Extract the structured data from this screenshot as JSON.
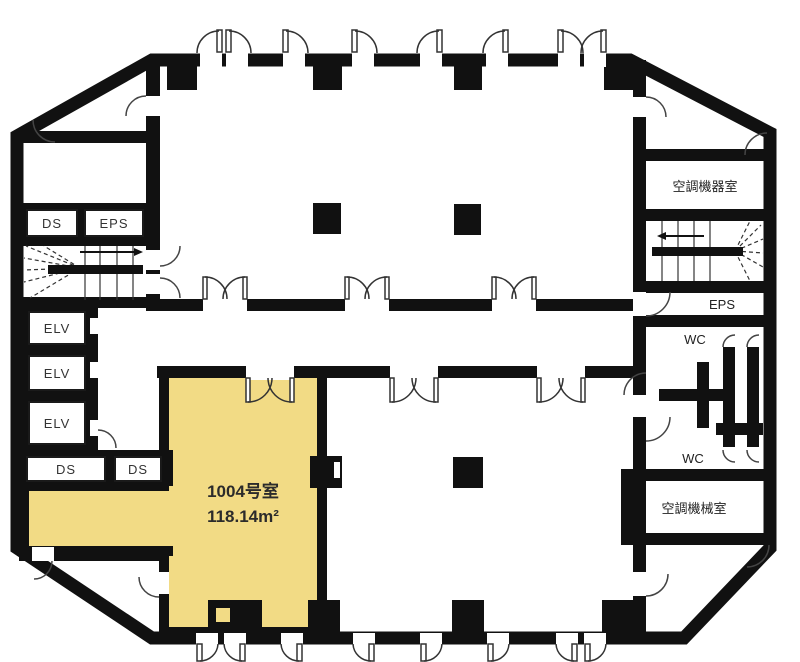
{
  "room": {
    "name": "1004号室",
    "area": "118.14m²"
  },
  "labels": {
    "ds_top": "DS",
    "eps_top": "EPS",
    "elv_1": "ELV",
    "elv_2": "ELV",
    "elv_3": "ELV",
    "ds_left_a": "DS",
    "ds_left_b": "DS",
    "ac_equipment_room": "空調機器室",
    "eps_right": "EPS",
    "wc_upper": "WC",
    "wc_lower": "WC",
    "ac_machine_room": "空調機械室"
  },
  "colors": {
    "highlight": "#F2DB85",
    "wall": "#111111",
    "background": "#FFFFFF",
    "label_text": "#333333"
  }
}
